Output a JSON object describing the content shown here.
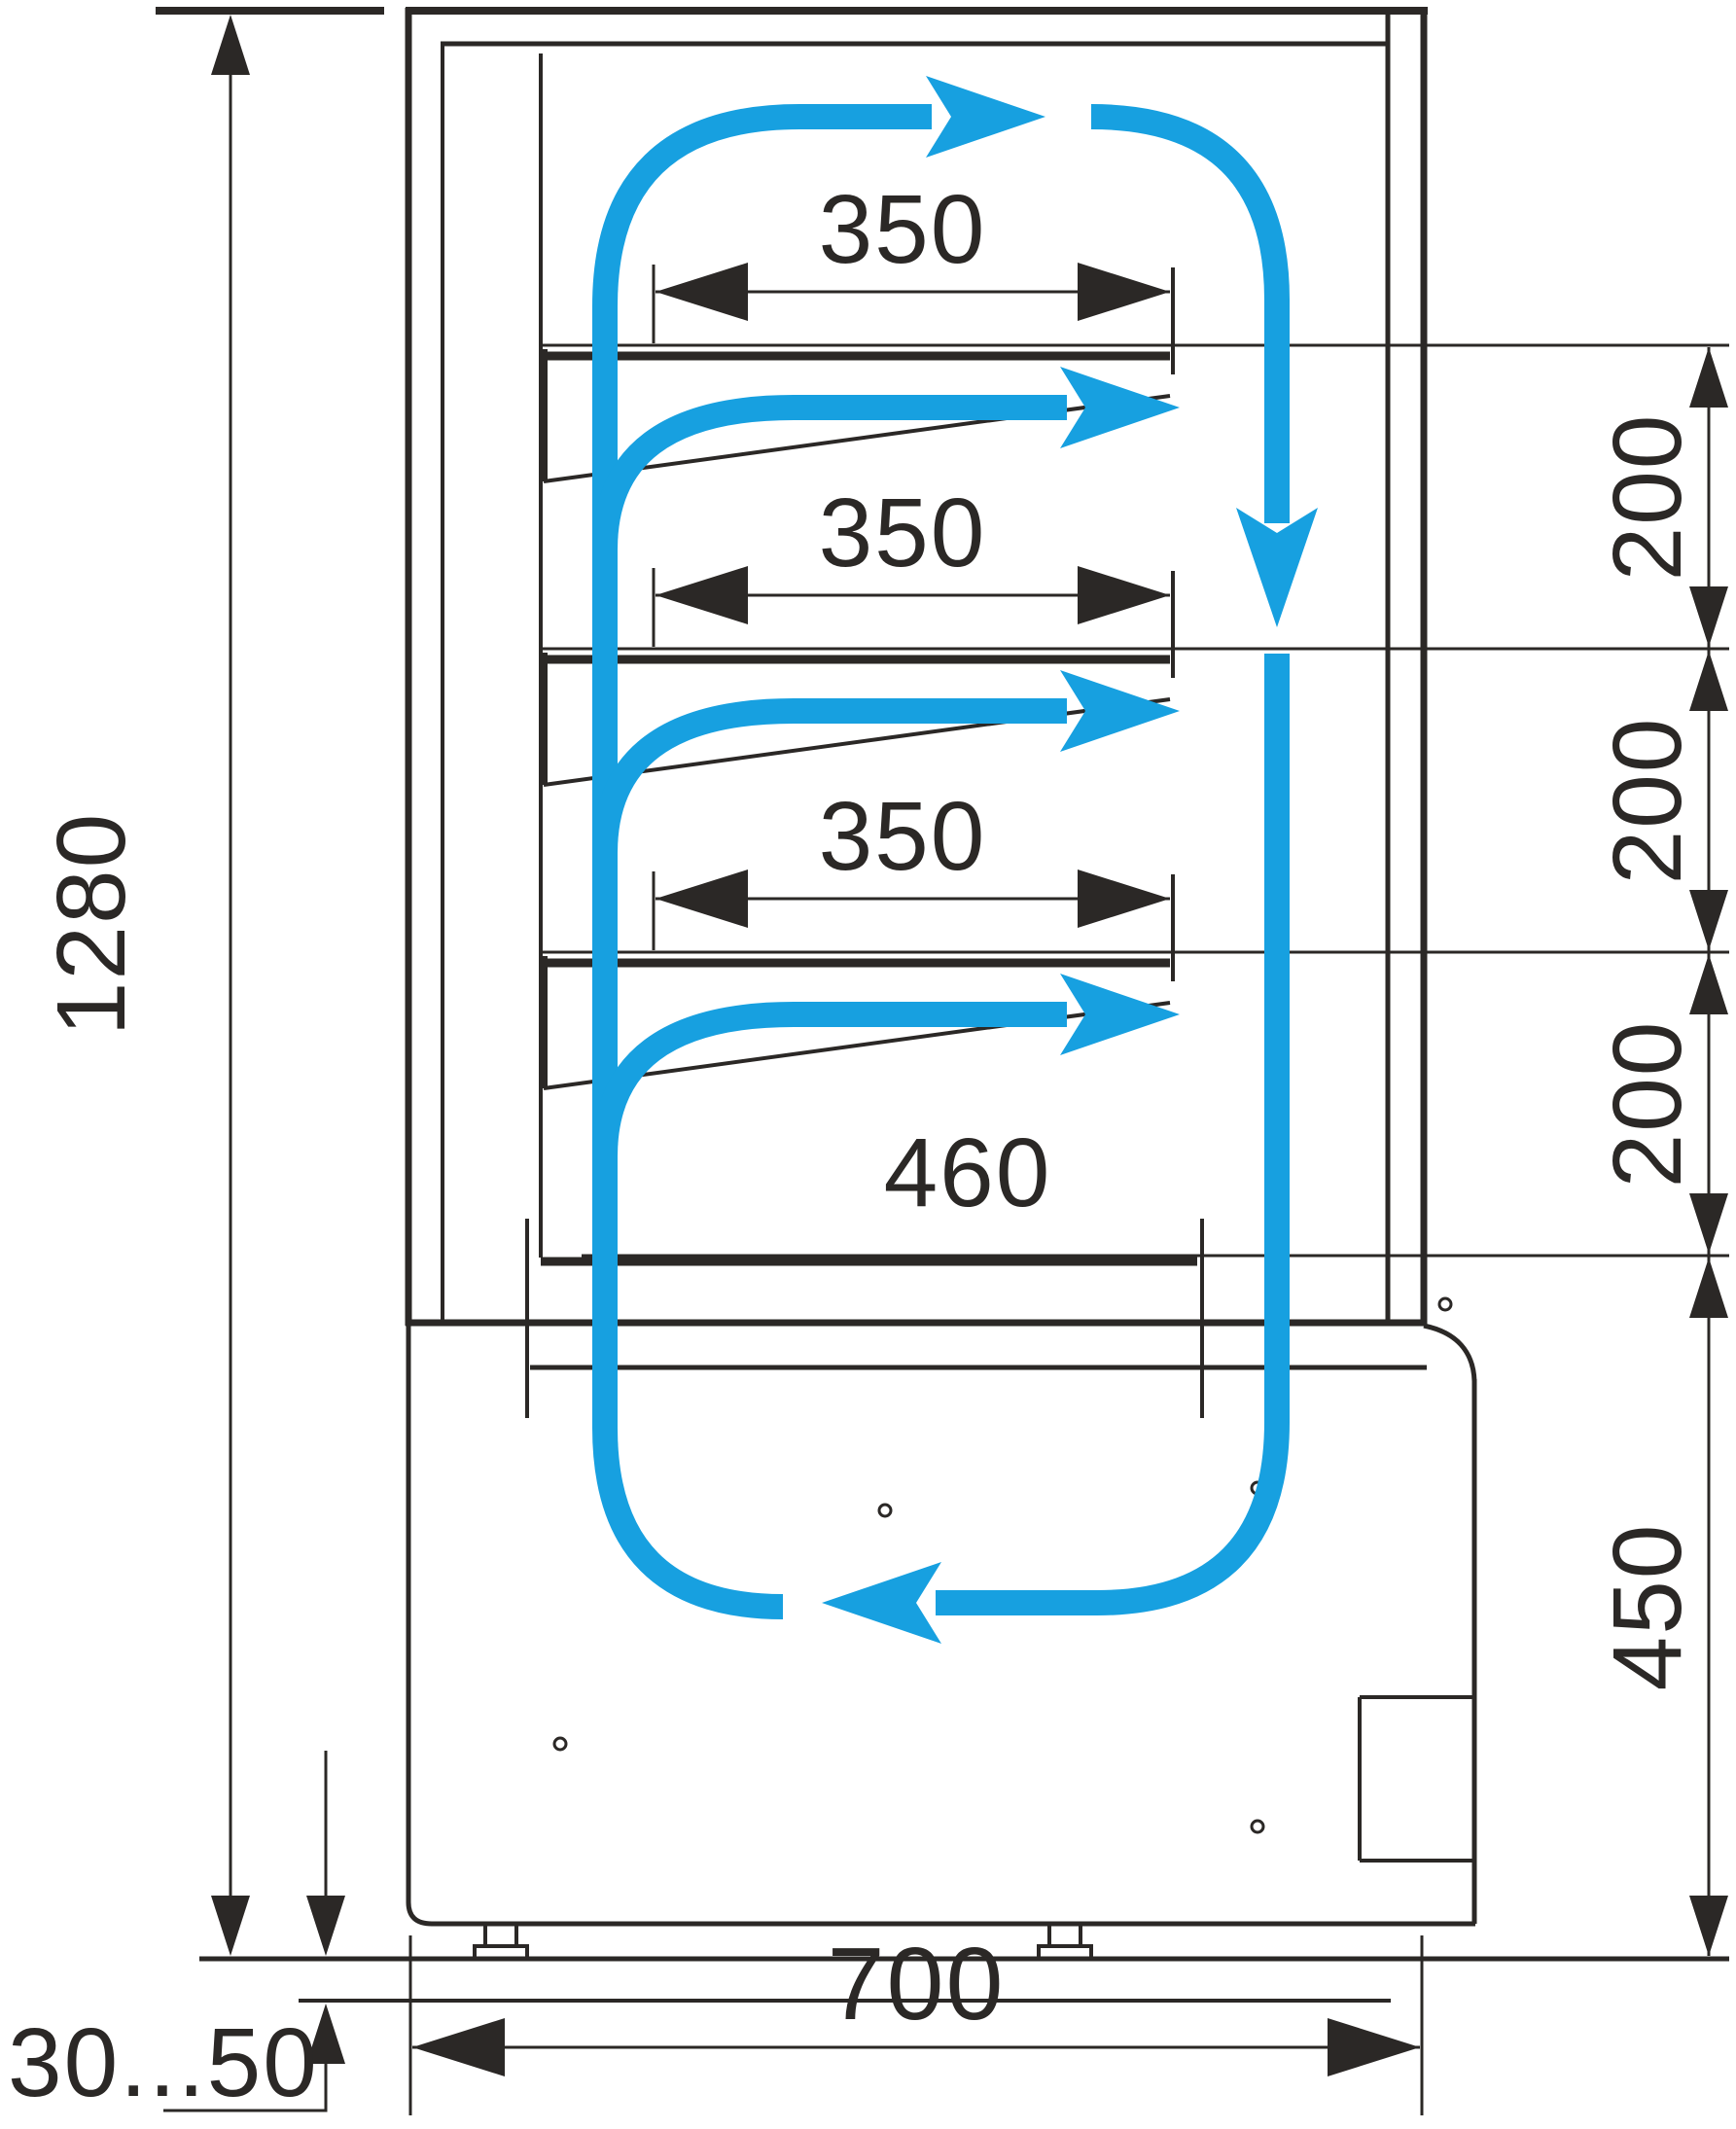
{
  "drawing": {
    "kind": "technical dimension drawing",
    "subject": "refrigerated confectionery display case - side cross-section with air circulation loop",
    "units": "mm",
    "colors": {
      "line": "#2b2826",
      "airflow_accent": "#17a0e0",
      "background": "#ffffff"
    }
  },
  "labels": {
    "overall_height": "1280",
    "shelf_depth_top": "350",
    "shelf_depth_mid": "350",
    "shelf_depth_low": "350",
    "bottom_shelf_depth": "460",
    "shelf_gap_1": "200",
    "shelf_gap_2": "200",
    "shelf_gap_3": "200",
    "base_section_height": "450",
    "overall_depth": "700",
    "leg_adjustment_range": "30...50"
  },
  "structure": {
    "shelves_count": 3,
    "bottom_deck": 1,
    "legs_count": 2,
    "screw_marks_count": 5
  },
  "airflow": {
    "color": "#17a0e0",
    "arrows": [
      {
        "name": "top-discharge-arrow",
        "direction": "right"
      },
      {
        "name": "front-glass-downflow-arrow",
        "direction": "down"
      },
      {
        "name": "under-shelf-arrow-1",
        "direction": "right"
      },
      {
        "name": "under-shelf-arrow-2",
        "direction": "right"
      },
      {
        "name": "under-shelf-arrow-3",
        "direction": "right"
      },
      {
        "name": "bottom-return-arrow",
        "direction": "left"
      }
    ]
  }
}
